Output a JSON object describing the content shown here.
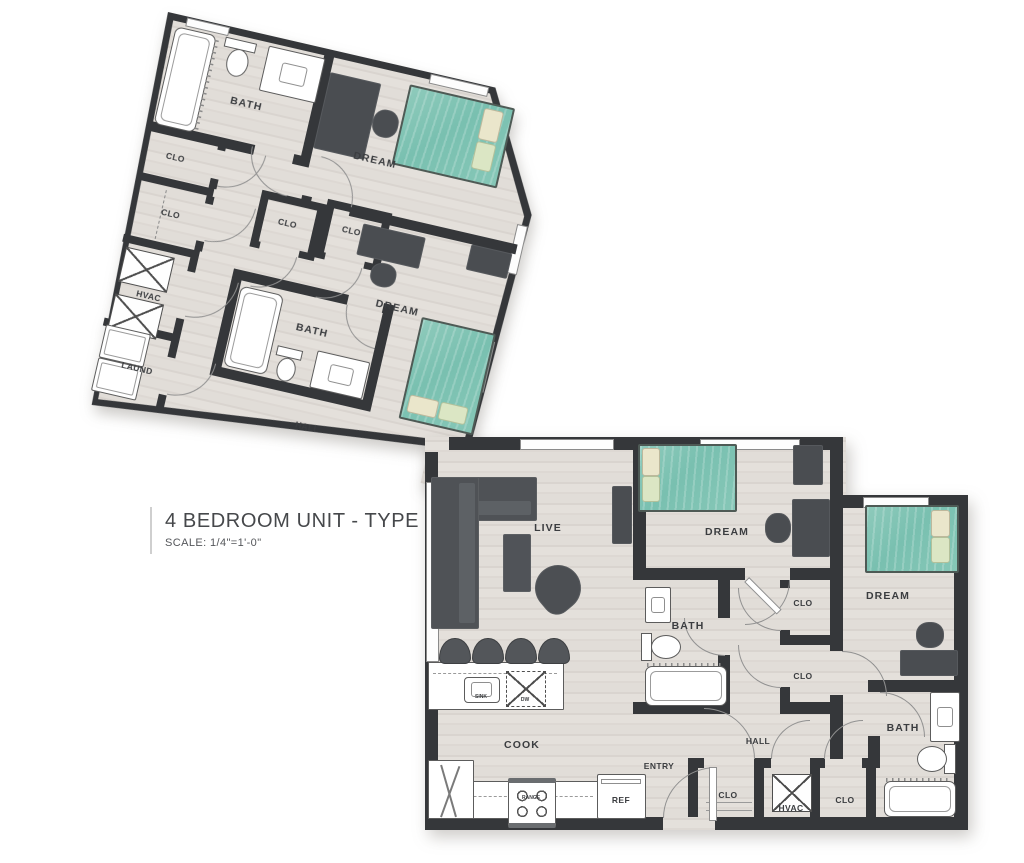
{
  "title_block": {
    "heading": "4 BEDROOM UNIT - TYPE 4G",
    "scale_note": "SCALE: 1/4\"=1'-0\""
  },
  "palette": {
    "wall": "#35373a",
    "floor": "#e1ddd8",
    "floor_stripe": "#d8d3ce",
    "furniture_dark": "#4a4d51",
    "bed_teal": "#7ec4b4",
    "pillow_cream": "#eae6cb",
    "pillow_green": "#dbe6c4",
    "fixture_outline": "#5c5c5c",
    "door_arc": "#919191",
    "label_color": "#3b3d40"
  },
  "upper_wing": {
    "bath_a": "BATH",
    "clo_a": "CLO",
    "clo_b": "CLO",
    "hvac": "HVAC",
    "laund": "LAUND",
    "clo_c": "CLO",
    "clo_d": "CLO",
    "dream_a": "DREAM",
    "dream_b": "DREAM",
    "bath_b": "BATH",
    "hall": "HALL"
  },
  "lower_wing": {
    "live": "LIVE",
    "dream_c": "DREAM",
    "dream_d": "DREAM",
    "bath_c": "BATH",
    "bath_d": "BATH",
    "clo_e": "CLO",
    "clo_f": "CLO",
    "clo_g": "CLO",
    "hvac_b": "HVAC",
    "clo_h": "CLO",
    "hall_b": "HALL",
    "entry": "ENTRY",
    "cook": "COOK",
    "ref": "REF",
    "sink": "SINK",
    "dw": "DW",
    "range": "RANGE"
  }
}
